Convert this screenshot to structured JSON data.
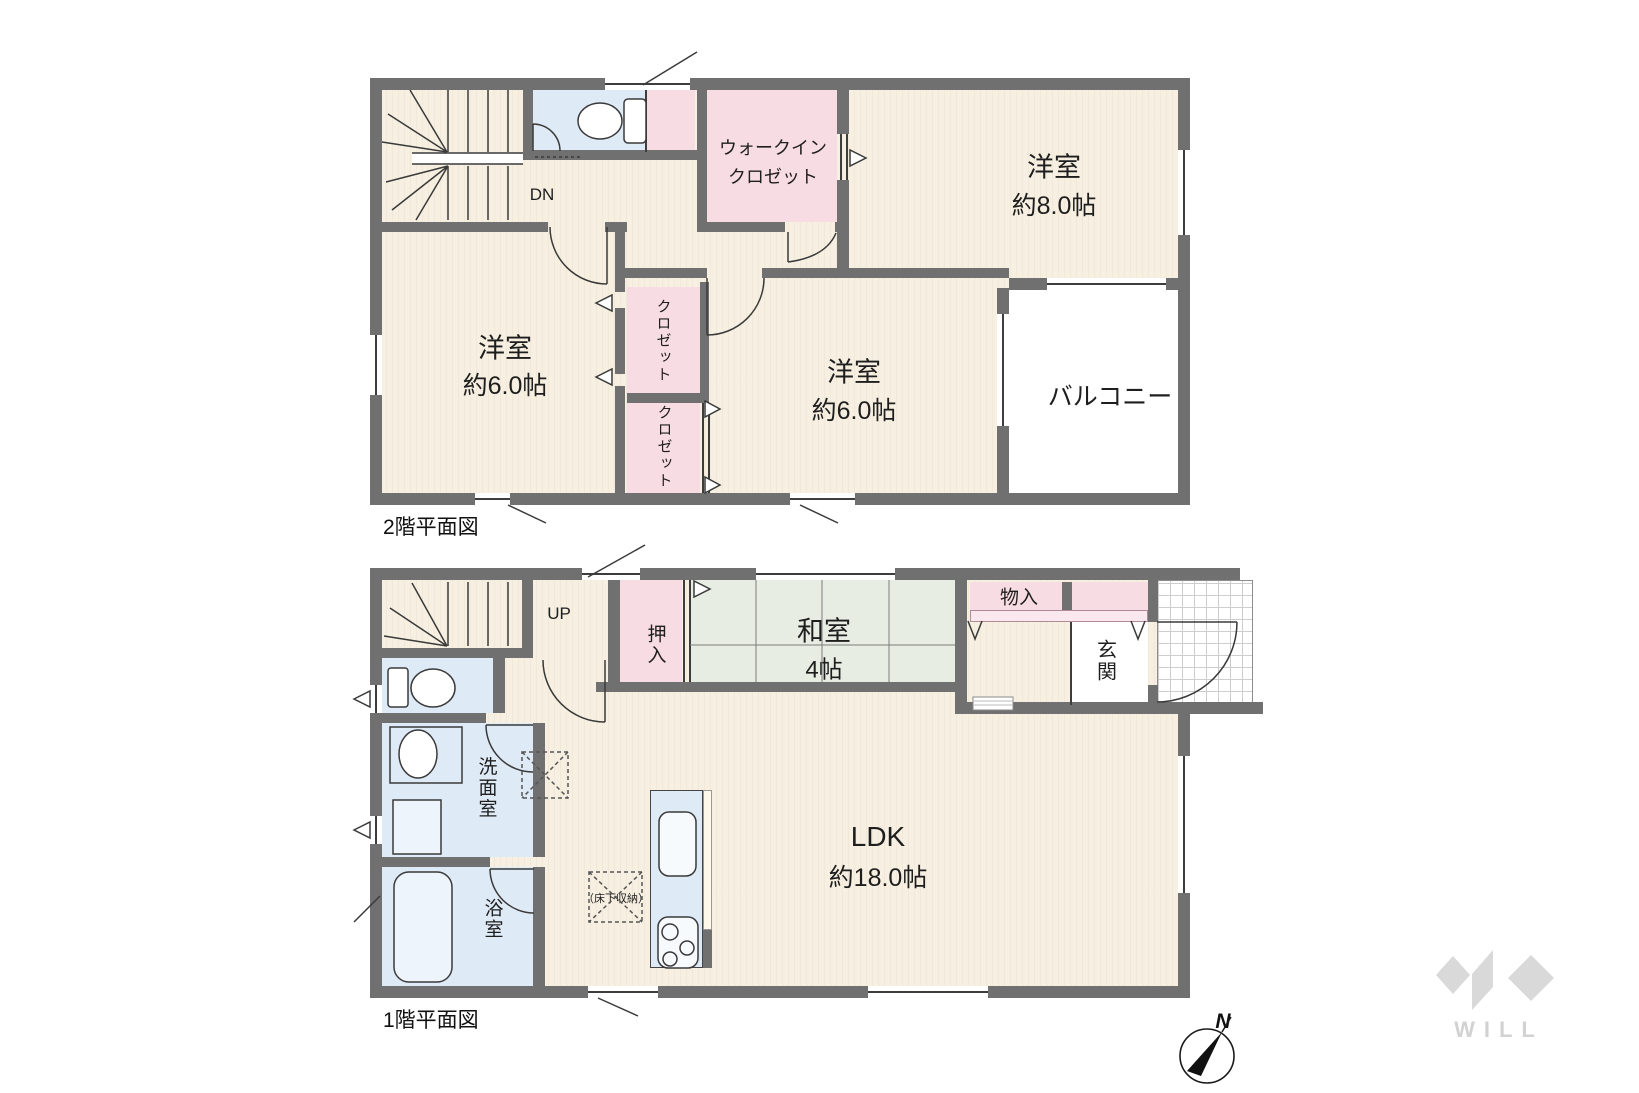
{
  "floor2": {
    "caption": "2階平面図",
    "stairs_label": "DN",
    "wic_line1": "ウォークイン",
    "wic_line2": "クロゼット",
    "room8_name": "洋室",
    "room8_size": "約8.0帖",
    "room6_left_name": "洋室",
    "room6_left_size": "約6.0帖",
    "room6_center_name": "洋室",
    "room6_center_size": "約6.0帖",
    "closet_upper": "クロゼット",
    "closet_lower": "クロゼット",
    "balcony": "バルコニー"
  },
  "floor1": {
    "caption": "1階平面図",
    "stairs_label": "UP",
    "oshiire": "押入",
    "washitsu_name": "和室",
    "washitsu_size": "4帖",
    "monoire": "物入",
    "genkan": "玄関",
    "senmenshitsu": "洗面室",
    "yokushitsu": "浴室",
    "ldk_name": "LDK",
    "ldk_size": "約18.0帖",
    "yukashita_label": "（床下収納）"
  },
  "compass": {
    "north_label": "N"
  },
  "logo": {
    "wordmark": "WILL"
  },
  "colors": {
    "wall": "#707070",
    "room_cream": "#f7f0e2",
    "closet_pink": "#f8dce3",
    "wet_area_blue": "#dfeaf7",
    "tatami_green": "#e7ede3",
    "logo_gray": "#d9d9d9"
  }
}
